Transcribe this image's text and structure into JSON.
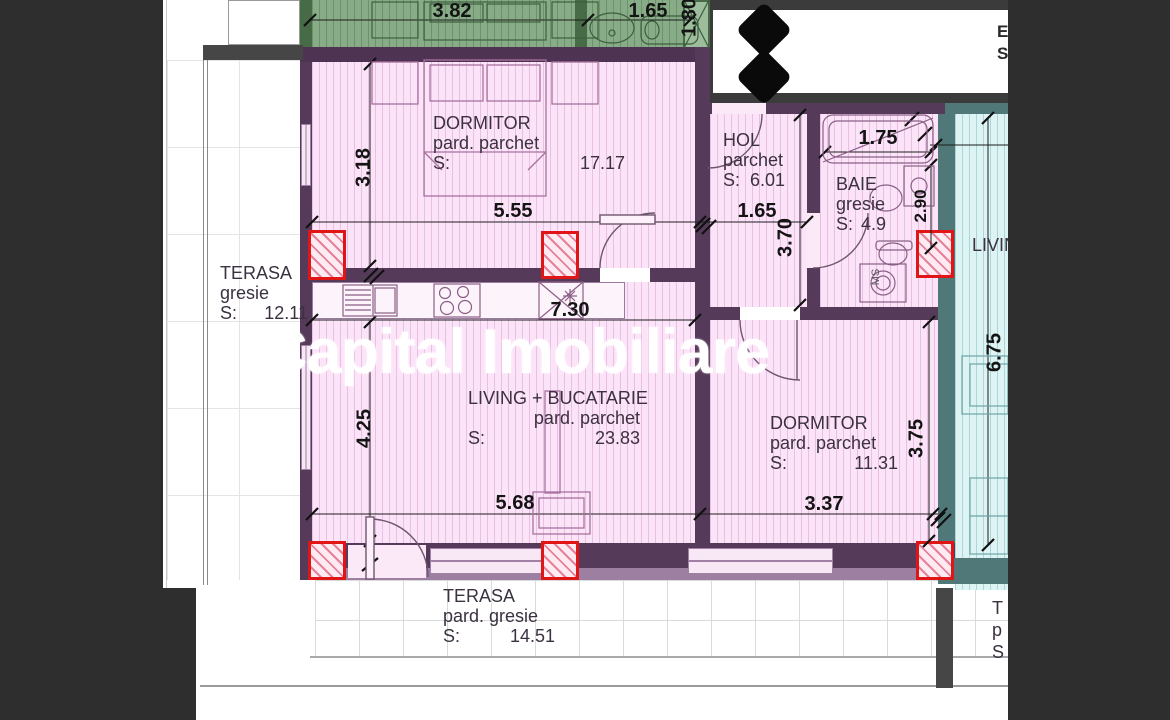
{
  "watermark": {
    "text": "Capital Imobiliare",
    "color": "#ffffff"
  },
  "banner": {
    "partial_line1": "E",
    "partial_line2": "S"
  },
  "logo": {
    "shape": "double-diamond",
    "color": "#0a0a0a"
  },
  "rooms": {
    "dormitor1": {
      "name": "DORMITOR",
      "finish": "pard. parchet",
      "area_label": "S:",
      "area": "17.17"
    },
    "hol": {
      "name": "HOL",
      "finish": "parchet",
      "area_label": "S:",
      "area": "6.01"
    },
    "baie": {
      "name": "BAIE",
      "finish": "gresie",
      "area_label": "S:",
      "area": "4.9"
    },
    "terasa_left": {
      "name": "TERASA",
      "finish": "gresie",
      "area_label": "S:",
      "area": "12.11"
    },
    "living_bucatarie": {
      "name": "LIVING + BUCATARIE",
      "finish": "pard. parchet",
      "area_label": "S:",
      "area": "23.83"
    },
    "dormitor2": {
      "name": "DORMITOR",
      "finish": "pard. parchet",
      "area_label": "S:",
      "area": "11.31"
    },
    "terasa_bottom": {
      "name": "TERASA",
      "finish": "pard. gresie",
      "area_label": "S:",
      "area": "14.51"
    },
    "living_neighbor": {
      "name": "LIVING"
    },
    "neighbor_partial": {
      "line1": "T",
      "line2": "p",
      "line3": "S"
    }
  },
  "dimensions": {
    "green_width": "3.82",
    "green_bath_width": "1.65",
    "green_window": "1.80",
    "dormitor1_height": "3.18",
    "dormitor1_width": "5.55",
    "hol_width": "1.65",
    "hol_height": "3.70",
    "bath_tub_width": "1.75",
    "bath_height": "2.90",
    "living_full_width": "7.30",
    "living_height": "4.25",
    "living_width": "5.68",
    "dormitor2_width": "3.37",
    "dormitor2_height": "3.75",
    "neighbor_living_height": "6.75"
  },
  "annotations": {
    "washing_machine": "MS"
  },
  "colors": {
    "room_pink": "#fce4f8",
    "wall_purple": "#553a59",
    "neighbor_green": "#87ac87",
    "neighbor_cyan": "#def4f4",
    "pillar_red": "#e01616",
    "teal_wall": "#507878",
    "frame_dark": "#2e2e2e",
    "watermark_white": "#ffffff"
  }
}
